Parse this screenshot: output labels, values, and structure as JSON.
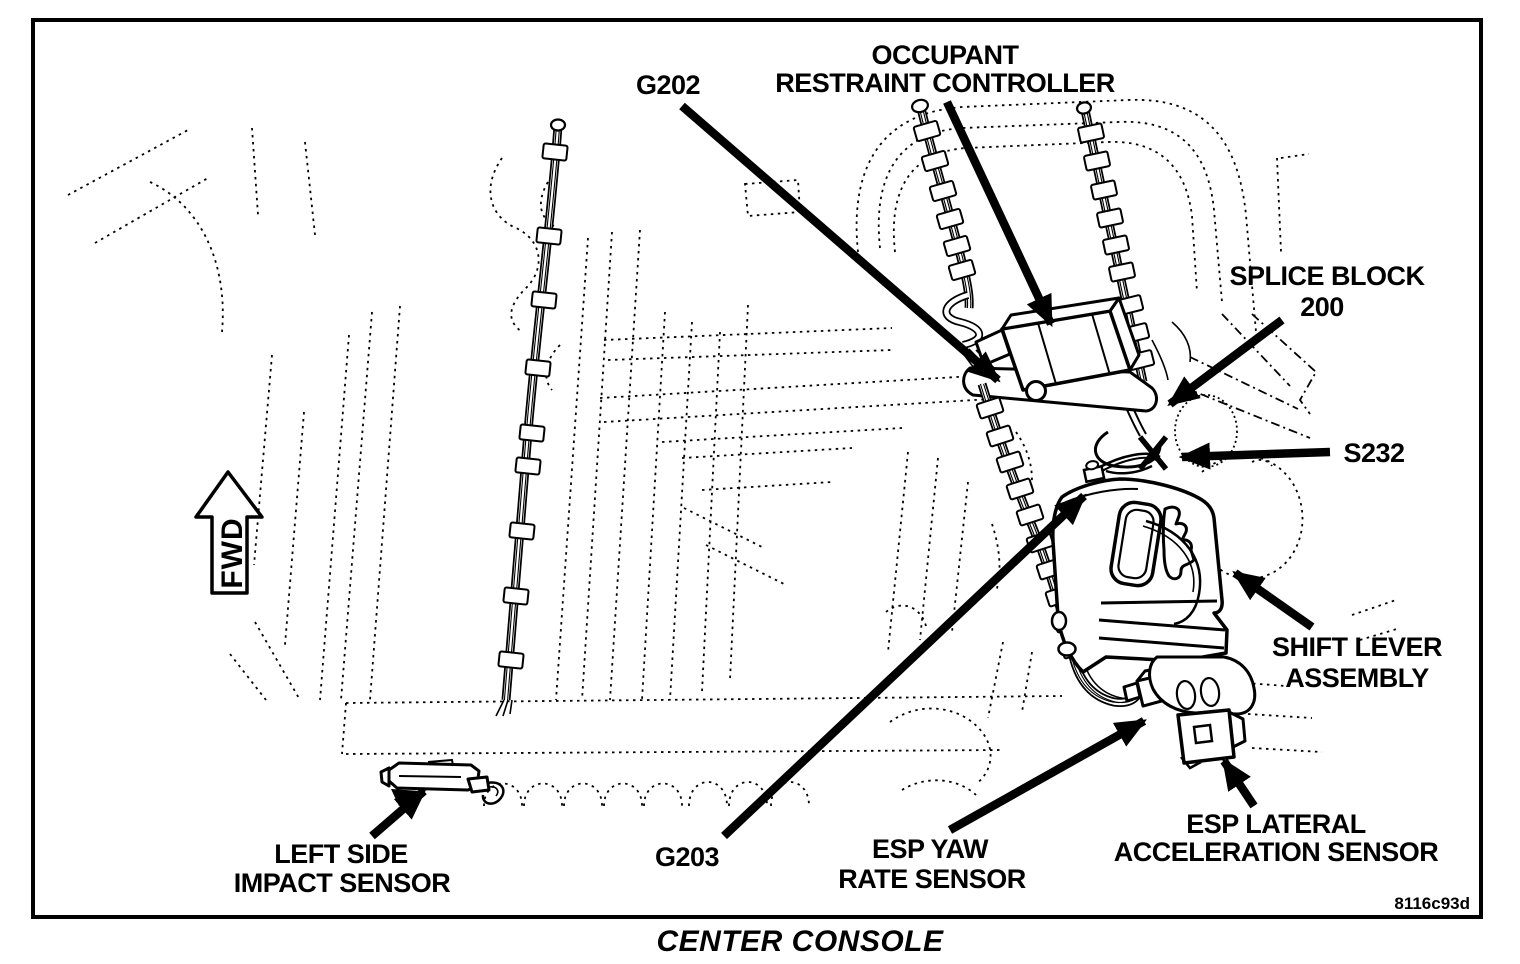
{
  "figure": {
    "caption": "CENTER CONSOLE",
    "code": "8116c93d",
    "orientation_arrow": "FWD"
  },
  "callouts": {
    "g202": {
      "label": "G202"
    },
    "orc": {
      "line1": "OCCUPANT",
      "line2": "RESTRAINT CONTROLLER"
    },
    "splice": {
      "line1": "SPLICE BLOCK",
      "line2": "200"
    },
    "s232": {
      "label": "S232"
    },
    "shift": {
      "line1": "SHIFT LEVER",
      "line2": "ASSEMBLY"
    },
    "esp_lateral": {
      "line1": "ESP LATERAL",
      "line2": "ACCELERATION SENSOR"
    },
    "esp_yaw": {
      "line1": "ESP YAW",
      "line2": "RATE SENSOR"
    },
    "g203": {
      "label": "G203"
    },
    "impact": {
      "line1": "LEFT SIDE",
      "line2": "IMPACT SENSOR"
    }
  },
  "colors": {
    "ink": "#000000",
    "paper": "#ffffff"
  }
}
